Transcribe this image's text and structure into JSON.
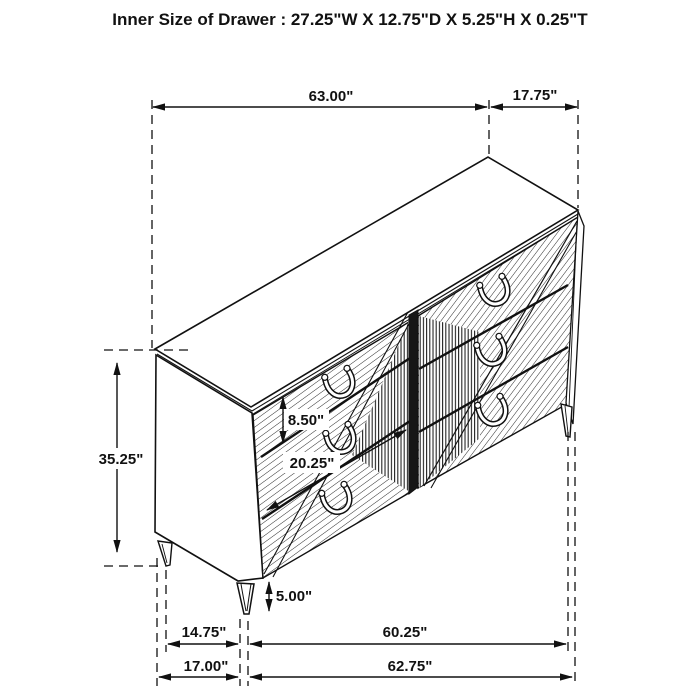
{
  "diagram": {
    "title": "Inner Size of Drawer : 27.25\"W X 12.75\"D X 5.25\"H X 0.25\"T",
    "dims": {
      "overall_width": "63.00\"",
      "depth": "17.75\"",
      "overall_height": "35.25\"",
      "drawer_front_height": "8.50\"",
      "drawer_depth": "20.25\"",
      "leg_height": "5.00\"",
      "side_leg_spacing": "14.75\"",
      "front_leg_spacing": "60.25\"",
      "side_width": "17.00\"",
      "front_width": "62.75\""
    },
    "colors": {
      "line": "#111111",
      "background": "#ffffff"
    }
  }
}
